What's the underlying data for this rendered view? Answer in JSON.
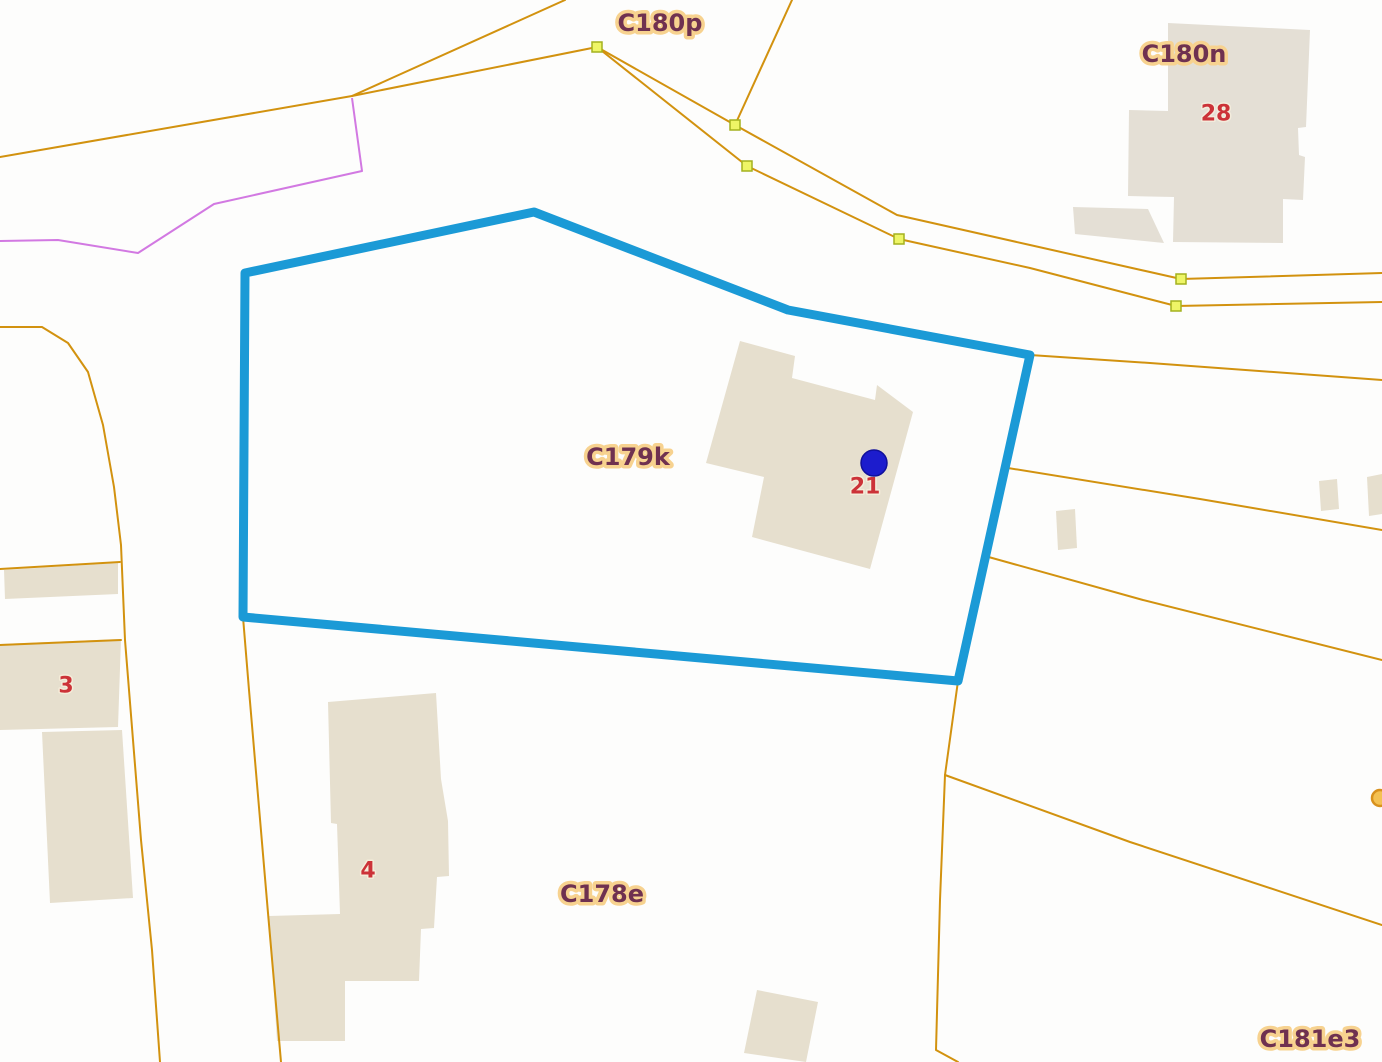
{
  "map": {
    "background": "#fdfdfc",
    "colors": {
      "building_fill": "#e6dfce",
      "building_fill_gray": "#e4dfd5",
      "parcel_line": "#d2920f",
      "magenta_line": "#d279e2",
      "highlight_stroke": "#1b9ad6",
      "label_text": "#6f3150",
      "label_halo": "#f7d28f",
      "number_text": "#cc3238",
      "vertex_fill": "#eef566",
      "vertex_stroke": "#a3b21f",
      "circle_marker_fill": "#f4c152",
      "circle_marker_stroke": "#d8911d",
      "point_fill": "#1c1ccd",
      "point_stroke": "#10109b"
    },
    "selected_parcel": {
      "label": "C179k",
      "points": "245,273 534,212 788,310 1030,355 958,681 243,617"
    },
    "point_marker": {
      "building_number": "21",
      "x": 874,
      "y": 463,
      "r": 13
    },
    "parcel_labels": [
      {
        "text": "C180p",
        "x": 660,
        "y": 23
      },
      {
        "text": "C180n",
        "x": 1184,
        "y": 54
      },
      {
        "text": "C179k",
        "x": 628,
        "y": 457
      },
      {
        "text": "C178e",
        "x": 602,
        "y": 894
      },
      {
        "text": "C181e3",
        "x": 1310,
        "y": 1039
      }
    ],
    "building_numbers": [
      {
        "text": "28",
        "x": 1216,
        "y": 114
      },
      {
        "text": "21",
        "x": 865,
        "y": 487
      },
      {
        "text": "3",
        "x": 66,
        "y": 686
      },
      {
        "text": "4",
        "x": 368,
        "y": 871
      }
    ],
    "buildings": [
      {
        "points": "1168,23 1310,30 1306,127 1298,128 1299,155 1305,157 1303,200 1283,199 1283,243 1173,242 1174,197 1128,196 1129,110 1168,111",
        "gray": true
      },
      {
        "points": "1073,207 1148,209 1164,243 1075,234",
        "gray": true
      },
      {
        "points": "740,341 795,356 792,378 875,400 877,385 913,412 870,569 752,537 764,477 706,463"
      },
      {
        "points": "328,702 436,693 441,779 448,821 449,876 437,877 434,928 421,929 419,981 345,981 345,1041 277,1041 269,916 340,914 337,824 331,823"
      },
      {
        "points": "0,644 121,639 118,727 0,730"
      },
      {
        "points": "42,732 122,730 133,898 50,903"
      },
      {
        "points": "4,570 118,563 118,594 5,599"
      },
      {
        "points": "1056,511 1075,509 1077,548 1058,550"
      },
      {
        "points": "1319,481 1337,479 1339,509 1321,511"
      },
      {
        "points": "1367,477 1382,474 1382,514 1369,516"
      },
      {
        "points": "757,990 818,1002 806,1062 744,1053"
      }
    ],
    "parcel_lines": [
      {
        "points": "0,157 352,96 597,47"
      },
      {
        "points": "565,0 352,96"
      },
      {
        "points": "597,47 735,125 897,215 1030,245 1181,279 1382,273"
      },
      {
        "points": "597,47 747,166 899,239 1030,268 1176,306 1382,302"
      },
      {
        "points": "792,0 735,125"
      },
      {
        "points": "1030,355 1150,363 1382,380"
      },
      {
        "points": "1008,468 1200,499 1382,530"
      },
      {
        "points": "985,556 1143,600 1382,660"
      },
      {
        "points": "958,681 945,775 940,900 936,1050 958,1062"
      },
      {
        "points": "945,775 1130,842 1382,925"
      },
      {
        "points": "243,617 249,690 268,913 281,1062"
      },
      {
        "points": "0,327 42,327 68,343 88,372 103,425 114,487 121,545 125,640 133,740 141,840 152,950 160,1062"
      },
      {
        "points": "0,645 121,640"
      },
      {
        "points": "0,569 120,562"
      }
    ],
    "magenta_line": {
      "points": "0,241 58,240 138,253 214,204 362,171 352,98"
    },
    "vertex_markers": [
      {
        "x": 597,
        "y": 47
      },
      {
        "x": 735,
        "y": 125
      },
      {
        "x": 747,
        "y": 166
      },
      {
        "x": 899,
        "y": 239
      },
      {
        "x": 1181,
        "y": 279
      },
      {
        "x": 1176,
        "y": 306
      }
    ],
    "circle_marker": {
      "x": 1380,
      "y": 798,
      "r": 8
    }
  }
}
